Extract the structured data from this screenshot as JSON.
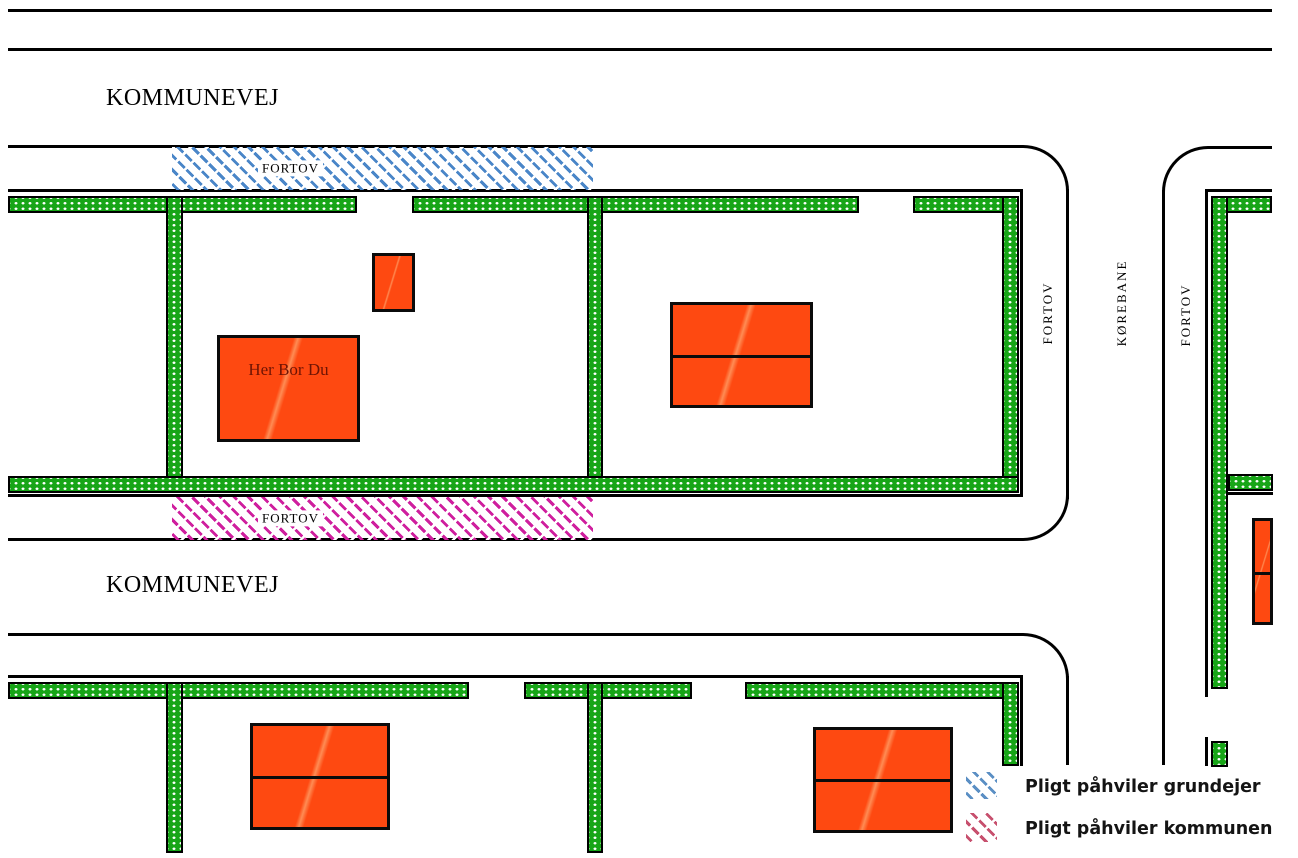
{
  "map": {
    "road_top_label": "KOMMUNEVEJ",
    "road_bottom_label": "KOMMUNEVEJ",
    "sidewalk_top_label": "FORTOV",
    "sidewalk_bottom_label": "FORTOV",
    "corridor": {
      "fortov_left_label": "FORTOV",
      "korebane_label": "KØREBANE",
      "fortov_right_label": "FORTOV"
    },
    "home_label": "Her Bor Du"
  },
  "legend": {
    "items": [
      {
        "id": "grundejer",
        "label": "Pligt påhviler grundejer",
        "hatch_color": "#5b8fc4"
      },
      {
        "id": "kommunen",
        "label": "Pligt påhviler kommunen",
        "hatch_color": "#c7506e"
      }
    ]
  },
  "colors": {
    "hedge_green": "#17a517",
    "building_orange": "#fe4911",
    "sidewalk_hatch_blue": "#4a86c8",
    "sidewalk_hatch_pink": "#cf1f9e",
    "legend_hatch_blue": "#5b8fc4",
    "legend_hatch_pink": "#c7506e",
    "home_label_text": "#6e1404",
    "line_black": "#000000"
  }
}
